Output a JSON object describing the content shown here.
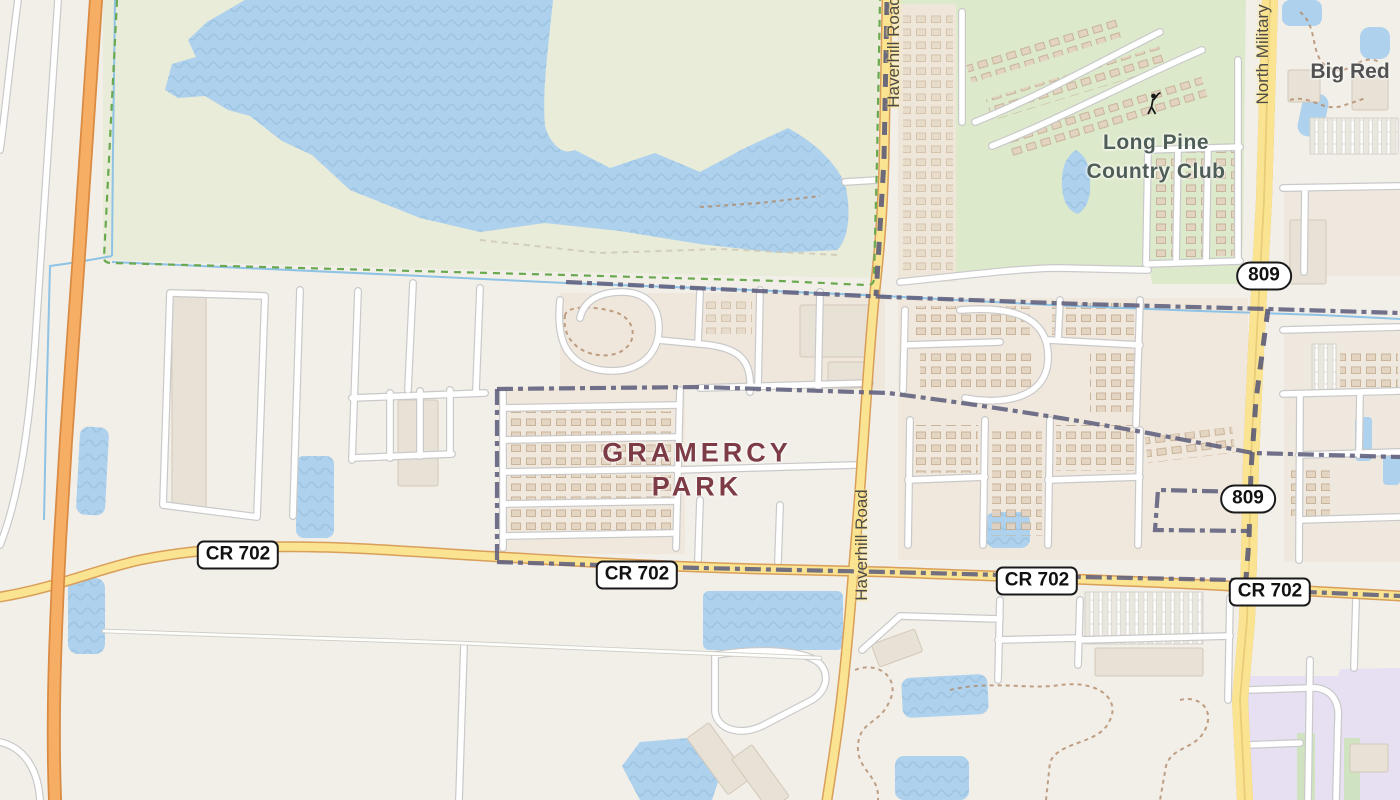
{
  "map": {
    "kind": "street-map",
    "background_color": "#f2efe8",
    "colors": {
      "water": "#aed1ed",
      "water_wave": "#8fb9d9",
      "preserve_green": "#e8ecd9",
      "golf_green": "#dde9cb",
      "residential": "#f0e8dd",
      "school_purple": "#e7dff2",
      "road_primary_fill": "#fbe491",
      "road_primary_casing": "#d99e59",
      "motorway_fill": "#f6ae65",
      "motorway_casing": "#d98a43",
      "minor_road_fill": "#ffffff",
      "minor_road_casing": "#c9c9c9",
      "admin_boundary": "#5e5e7d",
      "park_boundary": "#6aa94f",
      "stream": "#8ec3e6",
      "place_label": "#7c3b45"
    }
  },
  "place_labels": {
    "gramercy_park": {
      "line1": "GRAMERCY",
      "line2": "PARK"
    },
    "long_pine": {
      "line1": "Long Pine",
      "line2": "Country Club"
    },
    "big_red": {
      "text": "Big Red"
    }
  },
  "road_labels": {
    "haverhill_top": "Haverhill Road",
    "haverhill_mid": "Haverhill Road",
    "north_military": "North Military Trail"
  },
  "shields": {
    "cr702": "CR 702",
    "route809": "809"
  },
  "icons": {
    "golfer": "golfer-icon"
  }
}
